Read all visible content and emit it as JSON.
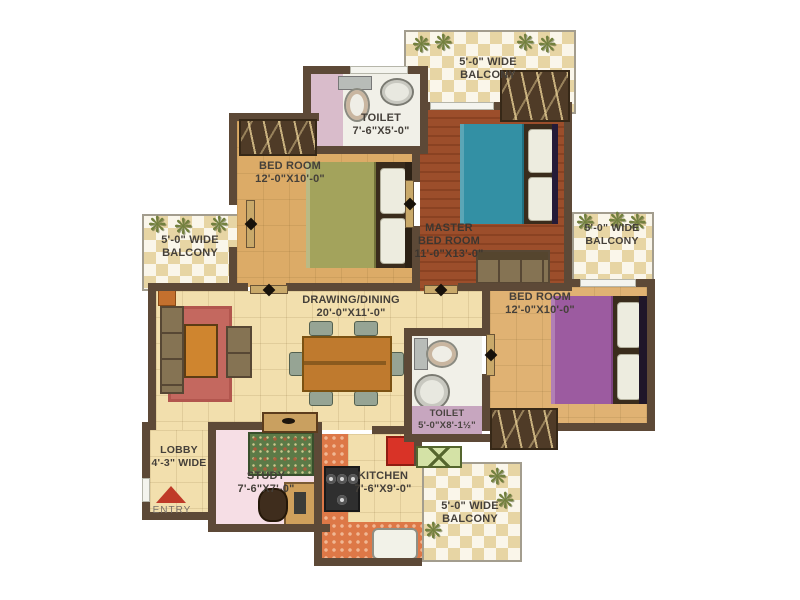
{
  "rooms": {
    "balcony_top": {
      "line1": "5'-0\" WIDE",
      "line2": "BALCONY"
    },
    "balcony_left": {
      "line1": "5'-0\" WIDE",
      "line2": "BALCONY"
    },
    "balcony_right": {
      "line1": "5'-0\" WIDE",
      "line2": "BALCONY"
    },
    "balcony_bottom": {
      "line1": "5'-0\" WIDE",
      "line2": "BALCONY"
    },
    "toilet_top": {
      "name": "TOILET",
      "dims": "7'-6\"X5'-0\""
    },
    "bedroom_left": {
      "name": "BED ROOM",
      "dims": "12'-0\"X10'-0\""
    },
    "master_bedroom": {
      "name1": "MASTER",
      "name2": "BED ROOM",
      "dims": "11'-0\"X13'-0\""
    },
    "bedroom_right": {
      "name": "BED ROOM",
      "dims": "12'-0\"X10'-0\""
    },
    "drawing_dining": {
      "name": "DRAWING/DINING",
      "dims": "20'-0\"X11'-0\""
    },
    "toilet_bottom": {
      "name": "TOILET",
      "dims": "5'-0\"X8'-1½\""
    },
    "lobby": {
      "name": "LOBBY",
      "dims": "4'-3\" WIDE"
    },
    "study": {
      "name": "STUDY",
      "dims": "7'-6\"X7'-0\""
    },
    "kitchen": {
      "name": "KITCHEN",
      "dims": "7'-6\"X9'-0\""
    }
  },
  "entry": {
    "label": "ENTRY"
  },
  "icons": {
    "plant_glyph": "❋"
  },
  "colors": {
    "wall": "#5d4937",
    "floor_cream": "#f2dfad",
    "floor_tan": "#dcab67",
    "floor_brick": "#9c4e2b",
    "balcony_check_dark": "#e7d5a4",
    "balcony_check_light": "#faf6ea",
    "toilet_pink": "#d9bccb",
    "toilet_band_purple": "#c7a6bf",
    "study_pink": "#f6dee5",
    "kitchen_counter": "#dd7847",
    "bed_green": "#a3a35c",
    "bed_teal": "#3390a4",
    "bed_purple": "#9c5ba0",
    "accent_red": "#d93327",
    "entry_red": "#bf3a28"
  }
}
